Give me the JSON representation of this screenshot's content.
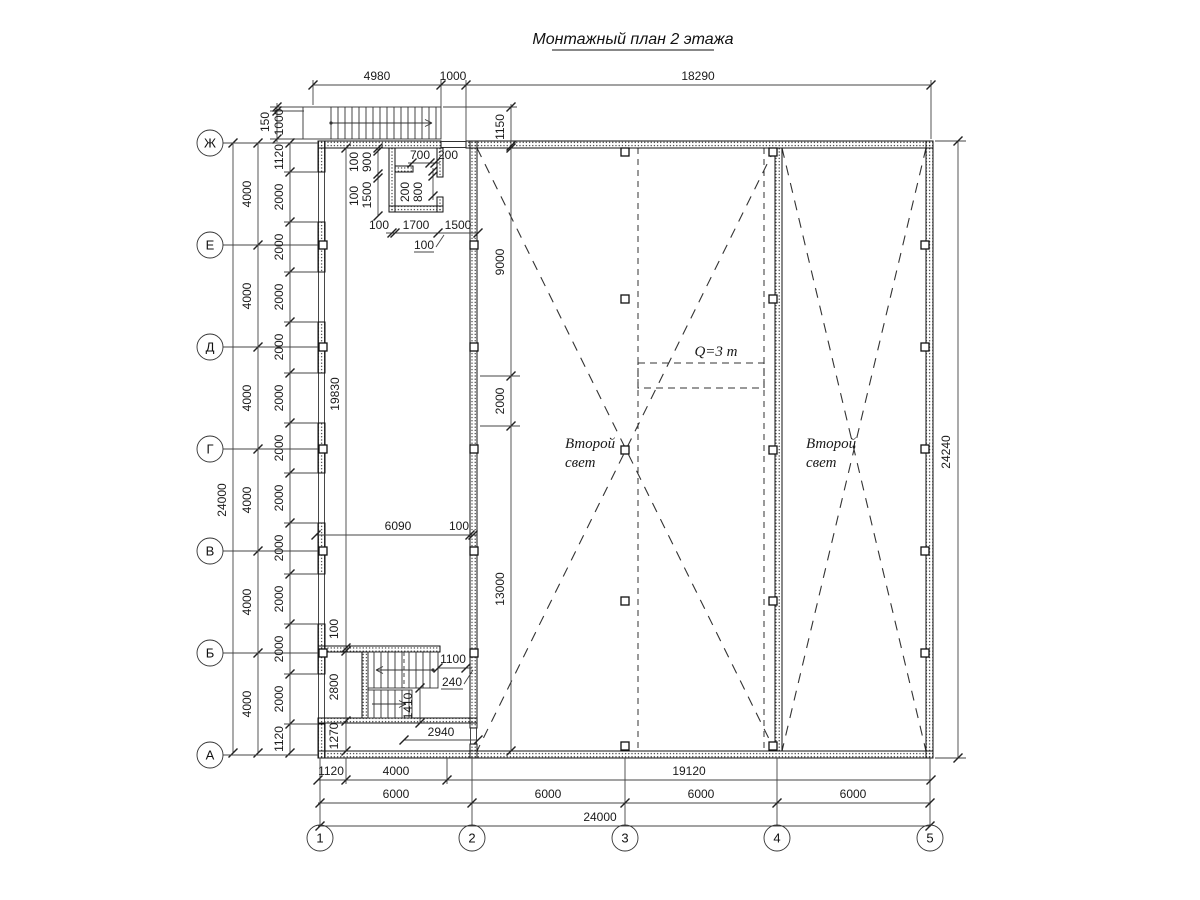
{
  "title": "Монтажный план 2 этажа",
  "axis_rows": [
    "Ж",
    "Е",
    "Д",
    "Г",
    "В",
    "Б",
    "А"
  ],
  "axis_cols": [
    "1",
    "2",
    "3",
    "4",
    "5"
  ],
  "dims_top": [
    "4980",
    "1000",
    "18290"
  ],
  "stair_top": {
    "h150": "150",
    "h1000": "1000"
  },
  "dim_1150": "1150",
  "left_chain_total": "24000",
  "left_chain_4000": [
    "4000",
    "4000",
    "4000",
    "4000",
    "4000",
    "4000"
  ],
  "left_chain_2000": [
    "1120",
    "2000",
    "2000",
    "2000",
    "2000",
    "2000",
    "2000",
    "2000",
    "2000",
    "2000",
    "2000",
    "2000",
    "1120"
  ],
  "hall_dims": {
    "v9000": "9000",
    "v2000": "2000",
    "v13000": "13000"
  },
  "room_dims": {
    "a100": "100",
    "a900": "900",
    "b100": "100",
    "b1500": "1500",
    "c700": "700",
    "c200": "200",
    "d200": "200",
    "d800": "800",
    "e100": "100",
    "e1700": "1700",
    "e1500": "1500",
    "f100": "100"
  },
  "leftbay_dims": {
    "h19830": "19830",
    "h6090": "6090",
    "h100": "100",
    "v100": "100",
    "v2800": "2800",
    "v1270": "1270"
  },
  "stair_dims": {
    "w1100": "1100",
    "w240": "240",
    "h1410": "1410",
    "w2940": "2940"
  },
  "crane_label": "Q=3 т",
  "second_light": {
    "line1": "Второй",
    "line2": "свет"
  },
  "dim_right_total": "24240",
  "bottom_chain1": [
    "1120",
    "4000",
    "19120"
  ],
  "bottom_chain2": [
    "6000",
    "6000",
    "6000",
    "6000"
  ],
  "bottom_total": "24000",
  "colors": {
    "line": "#1a1a1a",
    "dim": "#333333",
    "bg": "#ffffff"
  }
}
